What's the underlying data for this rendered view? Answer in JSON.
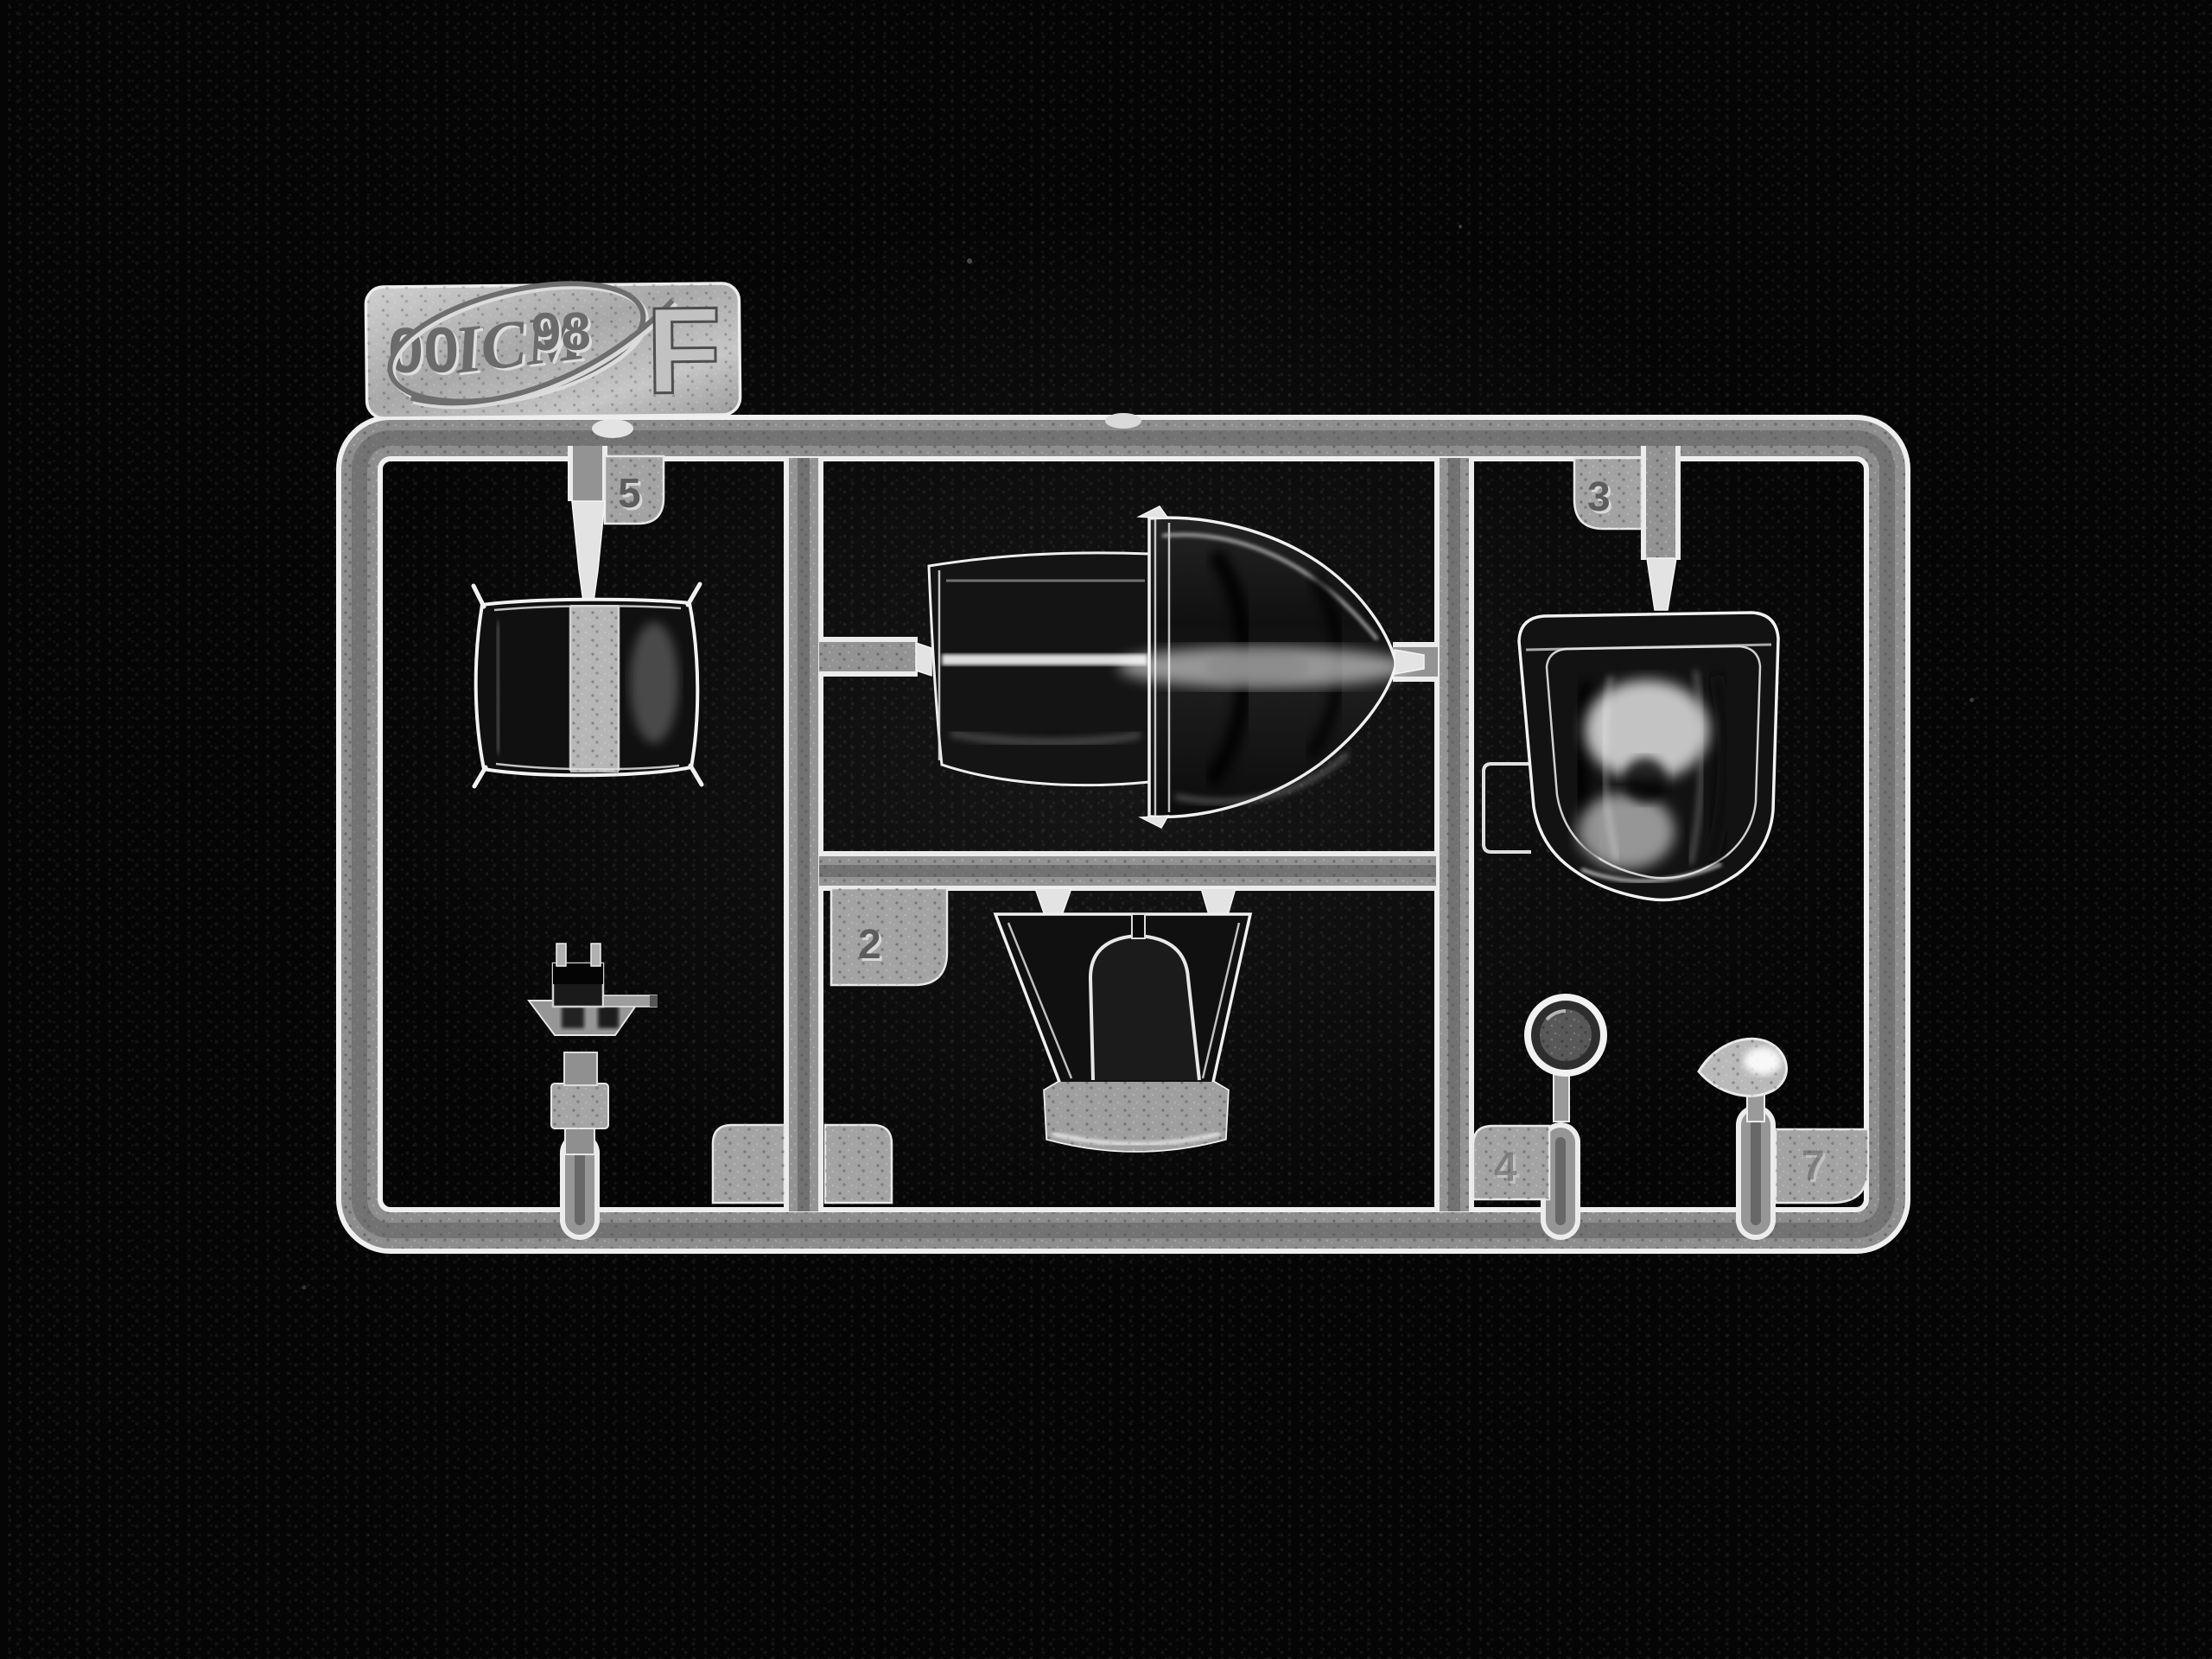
{
  "scene": {
    "subject": "Macro photograph of a clear injection-molded model kit sprue (runner) with transparent parts, lying on black knit fabric",
    "background": "black knit fabric",
    "material": "clear polystyrene"
  },
  "colors": {
    "background": "#050505",
    "rail_body": "#8d8d8d",
    "rail_edge": "#efefef",
    "glass_dark": "#131313",
    "frosted": "#a9a9a9",
    "highlight": "#ffffff"
  },
  "label_tag": {
    "mark_left": "00",
    "mark_right": "98",
    "brand": "ICM",
    "sprue_letter": "F"
  },
  "tabs": {
    "t5": "5",
    "t3": "3",
    "t2": "2",
    "t4": "4",
    "t7": "7"
  },
  "parts": [
    {
      "number": "5",
      "name": "small clear rectangular panel with frosted center band"
    },
    {
      "number": "",
      "name": "main canopy with blown bullet-shaped rear section (center, held between two runner arms)"
    },
    {
      "number": "2",
      "name": "windscreen with central arched frame and frosted base"
    },
    {
      "number": "3",
      "name": "large blown bubble canopy dome with side flange"
    },
    {
      "number": "4",
      "name": "small round lens on post"
    },
    {
      "number": "7",
      "name": "small teardrop light lens on post"
    },
    {
      "number": "",
      "name": "gunsight with dark reflector head on stepped pedestal"
    }
  ]
}
